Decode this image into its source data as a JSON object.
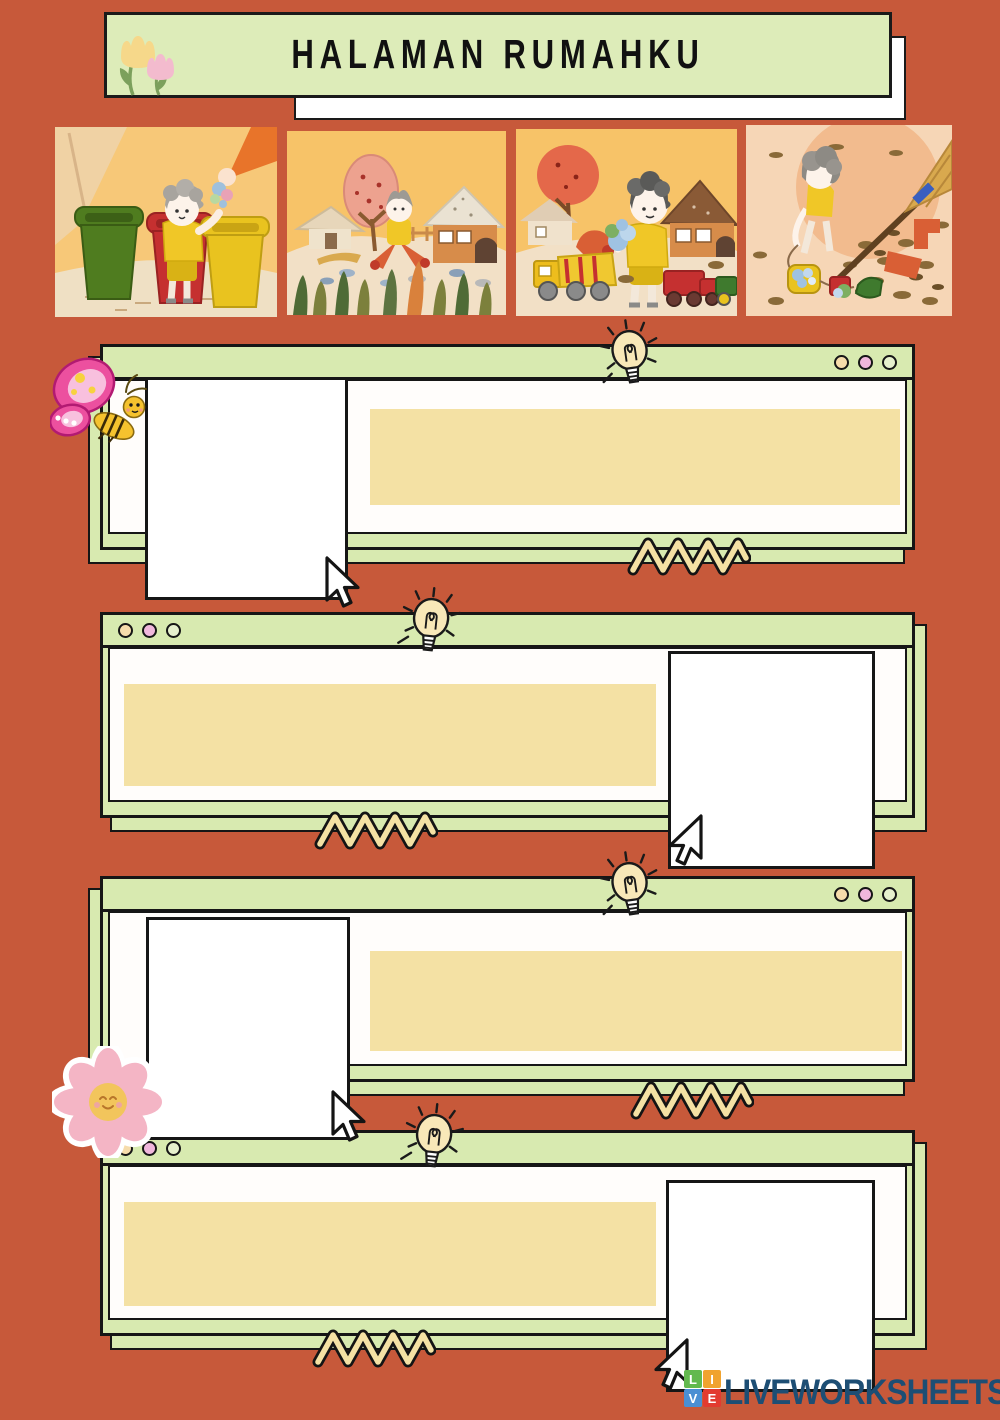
{
  "title": {
    "text": "HALAMAN RUMAHKU"
  },
  "colors": {
    "background": "#c7593a",
    "card_green": "#d8eab0",
    "text_bar_yellow": "#f4e1a4",
    "outline_black": "#1a1a1a",
    "dot_cream": "#f6dcab",
    "dot_pink": "#f0b7dc",
    "dot_pale_green": "#e6f0cd",
    "logo_blue": "#1d4e74"
  },
  "images": [
    {
      "name": "child-sorting-trash-into-bins"
    },
    {
      "name": "littered-yard-with-houses"
    },
    {
      "name": "boy-collecting-trash-with-toy-trucks"
    },
    {
      "name": "child-sweeping-windy-yard"
    }
  ],
  "icons": {
    "bulb": "lightbulb-doodle",
    "cursor": "mouse-pointer-arrow",
    "zigzag": "zigzag-ribbon",
    "butterfly": "butterfly-sticker",
    "flower": "smiling-flower-sticker",
    "tulips": "tulip-flowers"
  },
  "cards": [
    {
      "id": 1,
      "dots_position": "right",
      "answer_box": "left",
      "text_area": "right"
    },
    {
      "id": 2,
      "dots_position": "left",
      "answer_box": "right",
      "text_area": "left"
    },
    {
      "id": 3,
      "dots_position": "right",
      "answer_box": "left",
      "text_area": "right"
    },
    {
      "id": 4,
      "dots_position": "left",
      "answer_box": "right",
      "text_area": "left"
    }
  ],
  "logo": {
    "blocks": [
      {
        "letter": "L",
        "color": "#62b94e"
      },
      {
        "letter": "I",
        "color": "#f0a32f"
      },
      {
        "letter": "V",
        "color": "#4a8fd3"
      },
      {
        "letter": "E",
        "color": "#e23b30"
      }
    ],
    "text": "LIVEWORKSHEETS"
  }
}
